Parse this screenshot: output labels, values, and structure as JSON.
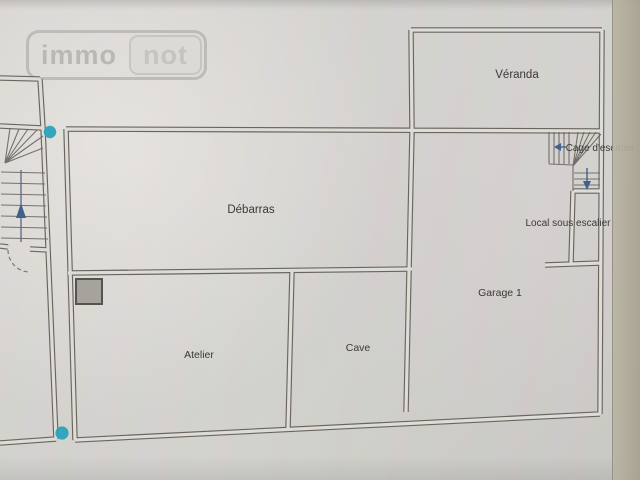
{
  "watermark": {
    "brand_left": "immo",
    "brand_right": "not"
  },
  "floorplan": {
    "room_labels": [
      {
        "name": "veranda",
        "label": "Véranda"
      },
      {
        "name": "debarras",
        "label": "Débarras"
      },
      {
        "name": "cage-escalier",
        "label": "Cage d'escalier"
      },
      {
        "name": "local-sous-escalier",
        "label": "Local sous escalier"
      },
      {
        "name": "garage-1",
        "label": "Garage 1"
      },
      {
        "name": "atelier",
        "label": "Atelier"
      },
      {
        "name": "cave",
        "label": "Cave"
      }
    ],
    "colors": {
      "wall": "#6a665e",
      "label_text": "#3a3935",
      "marker_dot": "#2ba2bc",
      "stair_arrow": "#41618c",
      "paper": "#d5d3cf"
    }
  }
}
